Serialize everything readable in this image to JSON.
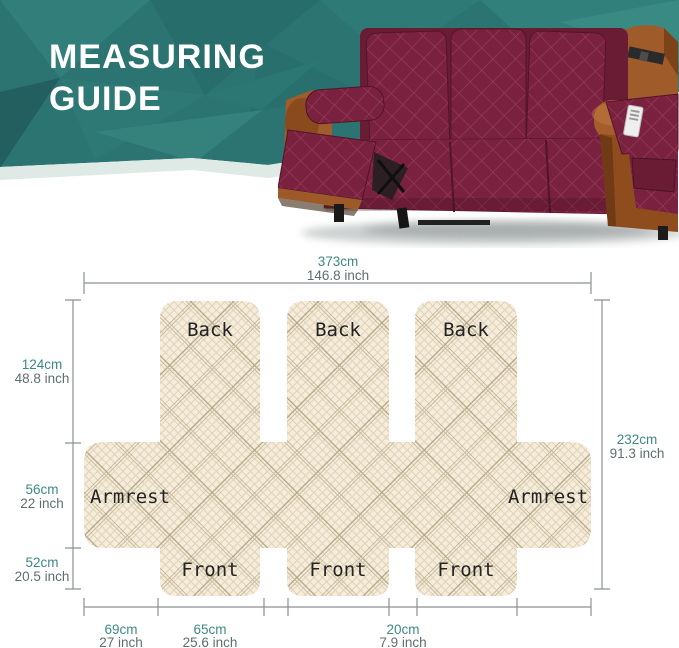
{
  "header": {
    "title_line1": "MEASURING",
    "title_line2": "GUIDE",
    "bg_color": "#2b7471",
    "strip_color": "#dfe9e6",
    "title_color": "#ffffff"
  },
  "sofa": {
    "cover_color": "#7a2140",
    "leather_color": "#9f5b2a"
  },
  "diagram": {
    "fabric_color": "#f6ecd9",
    "line_color": "#8b9191",
    "cm_color": "#3e8888",
    "inch_color": "#5f6e6e",
    "labels": {
      "back": "Back",
      "armrest": "Armrest",
      "front": "Front"
    },
    "measurements": {
      "top": {
        "cm": "373cm",
        "inch": "146.8 inch"
      },
      "left": [
        {
          "cm": "124cm",
          "inch": "48.8 inch"
        },
        {
          "cm": "56cm",
          "inch": "22 inch"
        },
        {
          "cm": "52cm",
          "inch": "20.5 inch"
        }
      ],
      "right": {
        "cm": "232cm",
        "inch": "91.3 inch"
      },
      "bottom": [
        {
          "cm": "69cm",
          "inch": "27 inch"
        },
        {
          "cm": "65cm",
          "inch": "25.6 inch"
        },
        {
          "cm": "20cm",
          "inch": "7.9 inch"
        }
      ]
    }
  }
}
